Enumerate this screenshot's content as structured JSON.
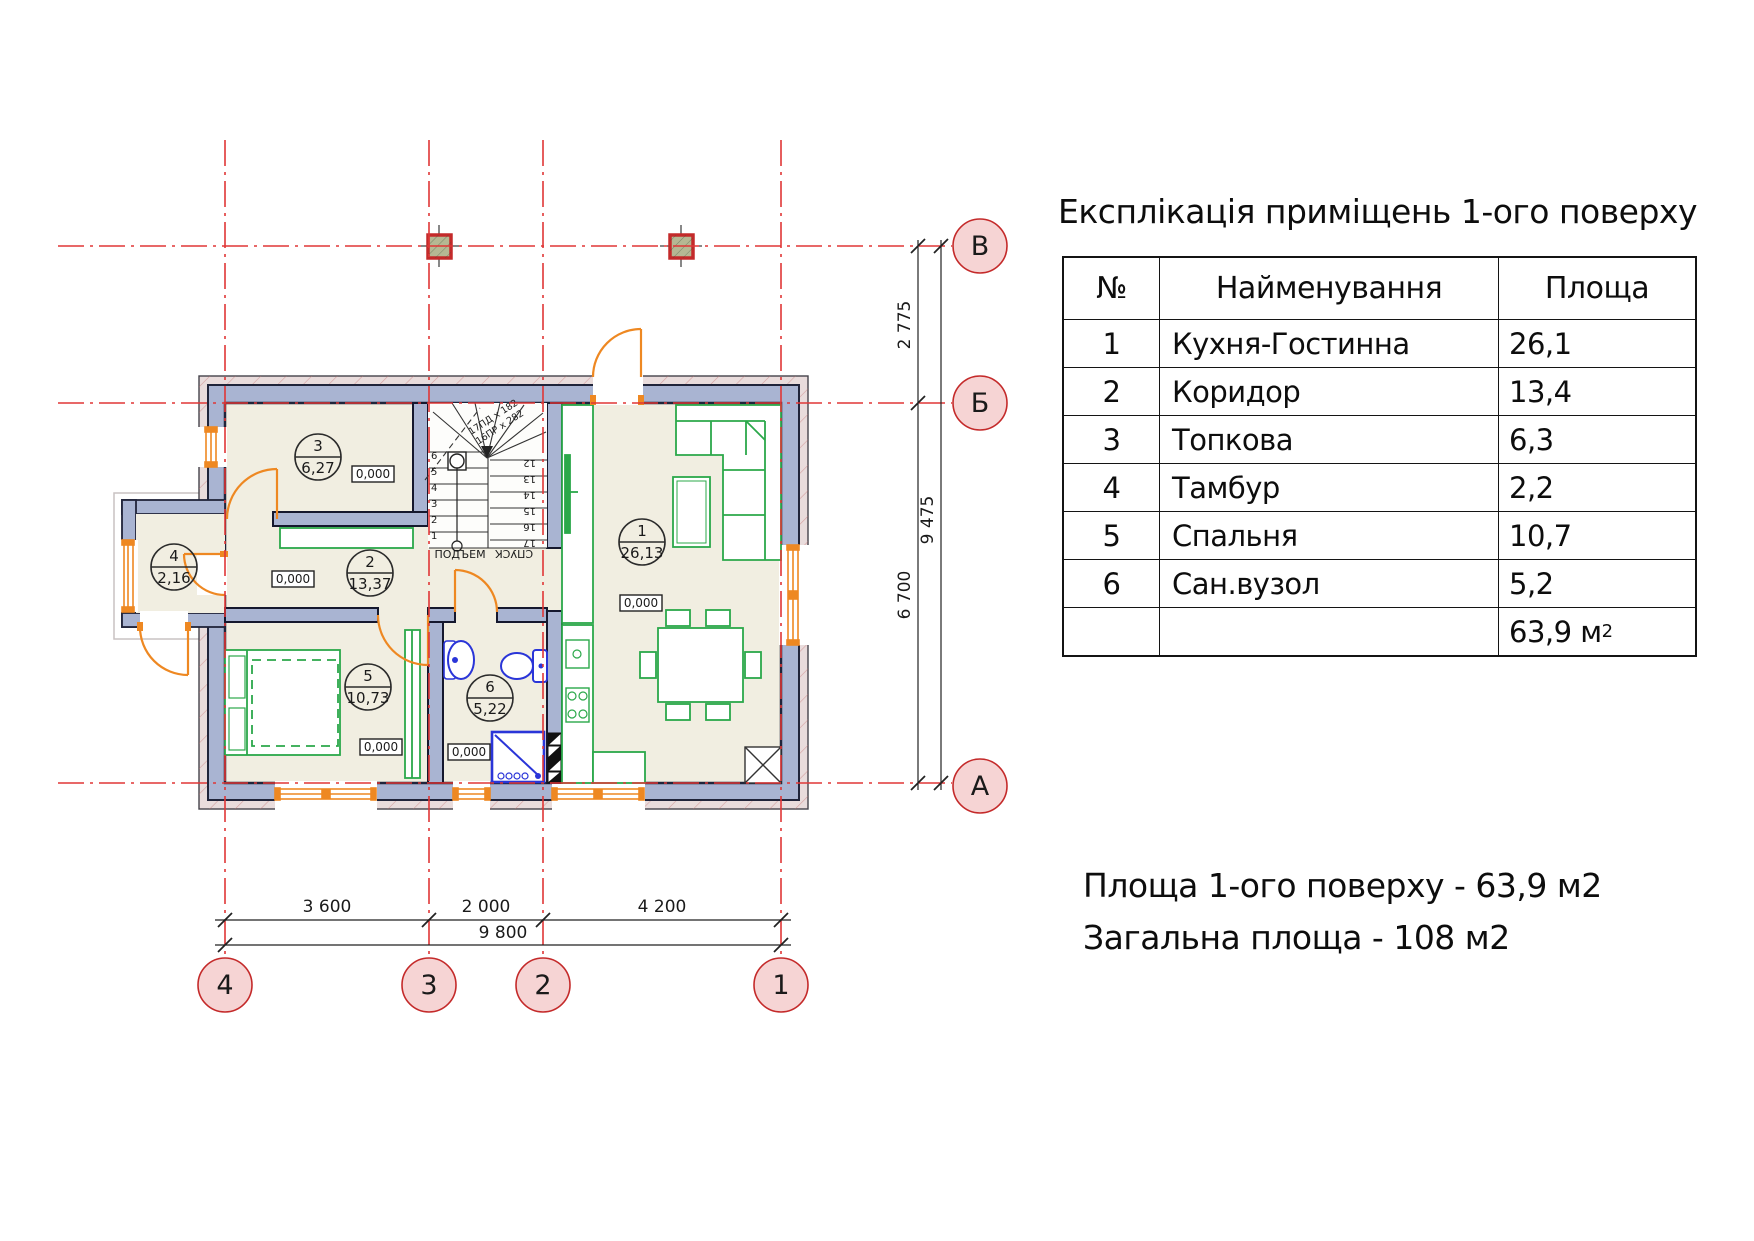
{
  "title": "Експлікація приміщень 1-ого поверху",
  "table": {
    "headers": [
      "№",
      "Найменування",
      "Площа"
    ],
    "rows": [
      {
        "n": "1",
        "name": "Кухня-Гостинна",
        "area": "26,1"
      },
      {
        "n": "2",
        "name": "Коридор",
        "area": "13,4"
      },
      {
        "n": "3",
        "name": "Топкова",
        "area": "6,3"
      },
      {
        "n": "4",
        "name": "Тамбур",
        "area": "2,2"
      },
      {
        "n": "5",
        "name": "Спальня",
        "area": "10,7"
      },
      {
        "n": "6",
        "name": "Сан.вузол",
        "area": "5,2"
      }
    ],
    "total_value": "63,9 м",
    "total_sup": "2"
  },
  "summary": {
    "line1": "Площа 1-ого поверху - 63,9 м2",
    "line2": "Загальна площа - 108 м2"
  },
  "plan": {
    "axis_rows": [
      "В",
      "Б",
      "А"
    ],
    "axis_cols": [
      "4",
      "3",
      "2",
      "1"
    ],
    "dims": {
      "right_segments": [
        "2 775",
        "6 700"
      ],
      "right_total": "9 475",
      "bottom_segments": [
        "3 600",
        "2 000",
        "4 200"
      ],
      "bottom_total": "9 800"
    },
    "elevation": "0,000",
    "rooms": [
      {
        "num": "3",
        "area": "6,27"
      },
      {
        "num": "4",
        "area": "2,16"
      },
      {
        "num": "2",
        "area": "13,37"
      },
      {
        "num": "5",
        "area": "10,73"
      },
      {
        "num": "6",
        "area": "5,22"
      },
      {
        "num": "1",
        "area": "26,13"
      }
    ],
    "stairs": {
      "up_label": "ПОДЪЕМ",
      "down_label": "СПУСК",
      "note1": "17ПД х 182",
      "note2": "16ПР х 282",
      "left_numbers": [
        "6",
        "5",
        "4",
        "3",
        "2",
        "1"
      ],
      "right_numbers": [
        "12",
        "13",
        "14",
        "15",
        "16",
        "17"
      ]
    }
  },
  "colors": {
    "wall_fill": "#a9b4d2",
    "wall_line": "#20243a",
    "insulation": "#e9dcdc",
    "floor": "#f1eee1",
    "axis_red": "#e03636",
    "bubble_fill": "#f6d4d4",
    "bubble_red": "#c42a2a",
    "furniture_green": "#2ba84a",
    "sanitary_blue": "#2a35d8",
    "door_orange": "#ee8822"
  }
}
